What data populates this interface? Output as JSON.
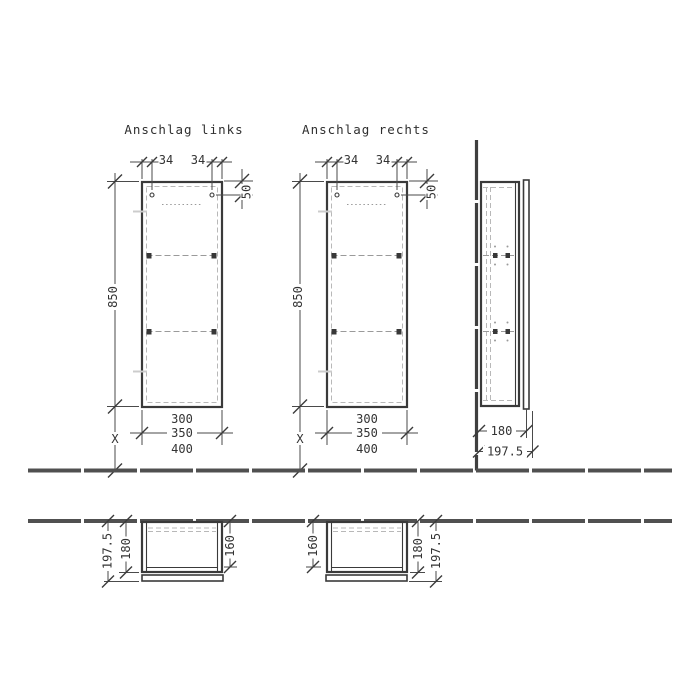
{
  "colors": {
    "background": "#ffffff",
    "line": "#3a3a3a",
    "dim": "#4a4a4a",
    "hidden_line": "#b8b8b8",
    "floor": "#505050"
  },
  "views": {
    "front_left": {
      "title": "Anschlag links",
      "dims": {
        "offset_l": "34",
        "offset_r": "34",
        "top": "50",
        "height": "850",
        "var_height": "X",
        "w1": "300",
        "w2": "350",
        "w3": "400"
      }
    },
    "front_right": {
      "title": "Anschlag rechts",
      "dims": {
        "offset_l": "34",
        "offset_r": "34",
        "top": "50",
        "height": "850",
        "var_height": "X",
        "w1": "300",
        "w2": "350",
        "w3": "400"
      }
    },
    "side": {
      "dims": {
        "body_depth": "180",
        "total_depth": "197.5"
      }
    },
    "top_left": {
      "dims": {
        "total_depth": "197.5",
        "body_depth": "180",
        "inner_depth": "160"
      }
    },
    "top_right": {
      "dims": {
        "inner_depth": "160",
        "body_depth": "180",
        "total_depth": "197.5"
      }
    }
  }
}
